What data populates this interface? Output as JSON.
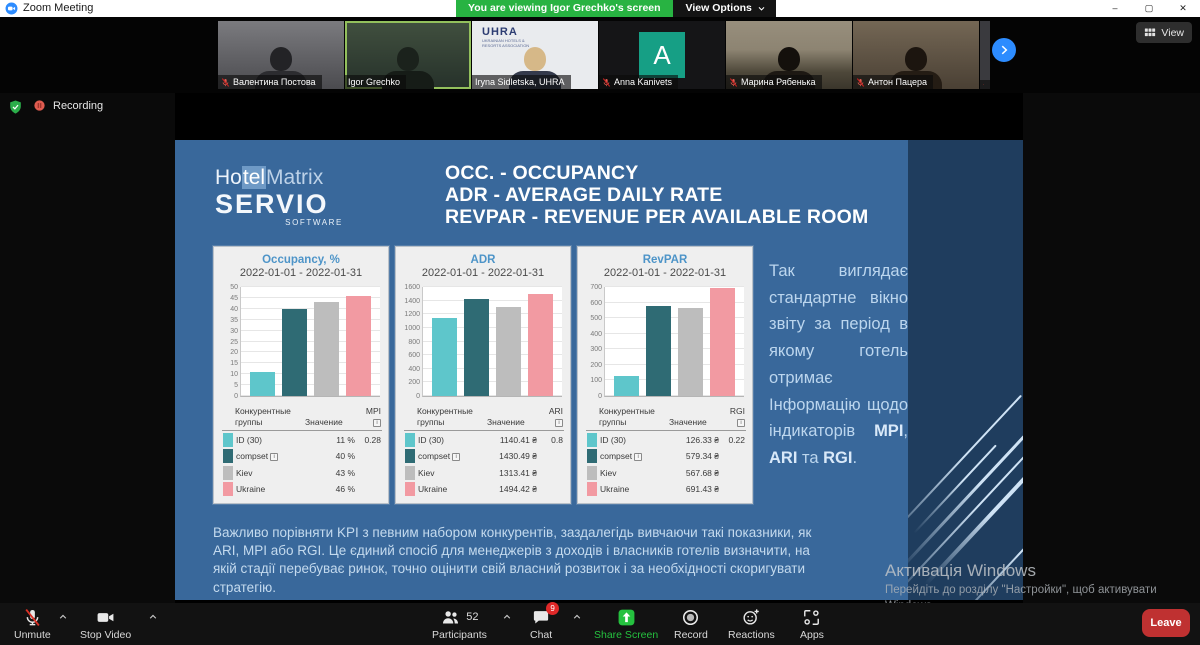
{
  "window": {
    "title": "Zoom Meeting",
    "banner": "You are viewing Igor Grechko's screen",
    "view_options_label": "View Options",
    "view_button_label": "View",
    "minimize": "–",
    "maximize": "▢",
    "close": "✕"
  },
  "status": {
    "recording_label": "Recording"
  },
  "filmstrip": {
    "participants": [
      {
        "name": "Валентина Постова",
        "muted": true,
        "active": false,
        "kind": "video"
      },
      {
        "name": "Igor Grechko",
        "muted": false,
        "active": true,
        "kind": "video"
      },
      {
        "name": "Iryna Sidletska, UHRA",
        "muted": false,
        "active": false,
        "kind": "video",
        "overlay_text": "UHRA",
        "overlay_subtext": "UKRAINIAN HOTELS & RESORTS ASSOCIATION"
      },
      {
        "name": "Anna Kanivets",
        "muted": true,
        "active": false,
        "kind": "initial",
        "initial": "A"
      },
      {
        "name": "Марина Рябенька",
        "muted": true,
        "active": false,
        "kind": "video"
      },
      {
        "name": "Антон Пацера",
        "muted": true,
        "active": false,
        "kind": "video"
      },
      {
        "name": "",
        "muted": true,
        "active": false,
        "kind": "partial"
      }
    ]
  },
  "slide": {
    "logo": {
      "part1": "Ho",
      "part2": "tel",
      "part3": "Matrix",
      "line2": "SERVIO",
      "line3": "SOFTWARE"
    },
    "title_lines": [
      "OCC. - OCCUPANCY",
      "ADR - AVERAGE DAILY RATE",
      "REVPAR - REVENUE PER AVAILABLE ROOM"
    ],
    "side_text_segments": [
      {
        "t": "Так виглядає стандартне вікно звіту за період в якому готель отримає Інформацію щодо індикаторів ",
        "b": false
      },
      {
        "t": "MPI",
        "b": true
      },
      {
        "t": ", ",
        "b": false
      },
      {
        "t": "ARI",
        "b": true
      },
      {
        "t": " та ",
        "b": false
      },
      {
        "t": "RGI",
        "b": true
      },
      {
        "t": ".",
        "b": false
      }
    ],
    "bottom_text": "Важливо порівняти KPI з певним набором конкурентів, заздалегідь вивчаючи такі показники, як ARI, MPI або RGI. Це єдиний спосіб для менеджерів з доходів і власників готелів визначити, на якій стадії перебуває ринок, точно оцінити свій власний розвиток і за необхідності скоригувати стратегію."
  },
  "chart_data": [
    {
      "type": "bar",
      "title": "Occupancy, %",
      "subtitle": "2022-01-01 - 2022-01-31",
      "categories": [
        "ID (30)",
        "compset",
        "Kiev",
        "Ukraine"
      ],
      "values": [
        11,
        40,
        43,
        46
      ],
      "value_labels": [
        "11 %",
        "40 %",
        "43 %",
        "46 %"
      ],
      "ylim": [
        0,
        50
      ],
      "ytick_step": 5,
      "index_label": "MPI",
      "index_value": "0.28",
      "grid": true,
      "legend_position": "table-below"
    },
    {
      "type": "bar",
      "title": "ADR",
      "subtitle": "2022-01-01 - 2022-01-31",
      "categories": [
        "ID (30)",
        "compset",
        "Kiev",
        "Ukraine"
      ],
      "values": [
        1140.41,
        1430.49,
        1313.41,
        1494.42
      ],
      "value_labels": [
        "1140.41 ₴",
        "1430.49 ₴",
        "1313.41 ₴",
        "1494.42 ₴"
      ],
      "ylim": [
        0,
        1600
      ],
      "ytick_step": 200,
      "index_label": "ARI",
      "index_value": "0.8",
      "grid": true,
      "legend_position": "table-below"
    },
    {
      "type": "bar",
      "title": "RevPAR",
      "subtitle": "2022-01-01 - 2022-01-31",
      "categories": [
        "ID (30)",
        "compset",
        "Kiev",
        "Ukraine"
      ],
      "values": [
        126.33,
        579.34,
        567.68,
        691.43
      ],
      "value_labels": [
        "126.33 ₴",
        "579.34 ₴",
        "567.68 ₴",
        "691.43 ₴"
      ],
      "ylim": [
        0,
        700
      ],
      "ytick_step": 100,
      "index_label": "RGI",
      "index_value": "0.22",
      "grid": true,
      "legend_position": "table-below"
    }
  ],
  "kpi_table": {
    "col_groups": "Конкурентные группы",
    "col_value": "Значение",
    "info_marked_category": "compset"
  },
  "bar_colors": [
    "#5ec6cb",
    "#2f6b74",
    "#bdbdbd",
    "#f29aa2"
  ],
  "watermark": {
    "line1": "Активація Windows",
    "line2": "Перейдіть до розділу \"Настройки\", щоб активувати",
    "line3": "Windows."
  },
  "toolbar": {
    "unmute": "Unmute",
    "stop_video": "Stop Video",
    "participants": "Participants",
    "participants_count": "52",
    "chat": "Chat",
    "chat_badge": "9",
    "share": "Share Screen",
    "record": "Record",
    "reactions": "Reactions",
    "apps": "Apps",
    "leave": "Leave"
  },
  "colors": {
    "banner_green": "#28b342",
    "share_green": "#25c13f",
    "leave_red": "#bf3131",
    "slide_blue": "#39689b",
    "slide_dark_blue": "#1f3d5e",
    "accent_blue": "#2d8cff"
  }
}
